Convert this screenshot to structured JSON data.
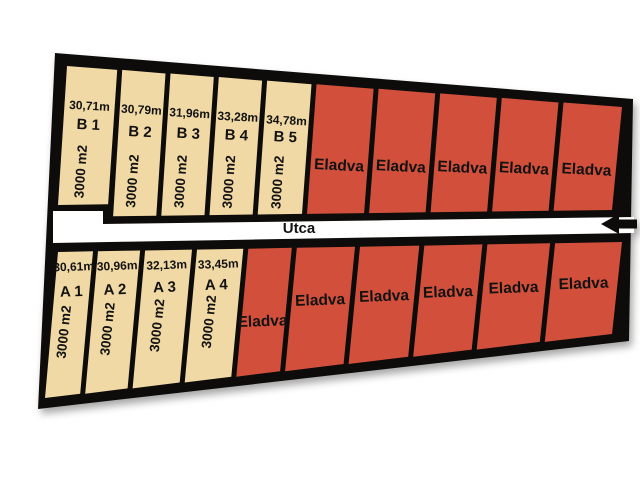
{
  "diagram": {
    "street": {
      "label": "Utca"
    },
    "sold_label": "Eladva",
    "colors": {
      "available": "#F0D9A4",
      "sold": "#D2503B",
      "outline": "#0D0C0A",
      "street": "#FFFFFF",
      "text": "#121212"
    },
    "rows": [
      {
        "name": "B",
        "plots": [
          {
            "status": "available",
            "label": "B 1",
            "frontage": "30,71m",
            "area": "3000 m2"
          },
          {
            "status": "available",
            "label": "B 2",
            "frontage": "30,79m",
            "area": "3000 m2"
          },
          {
            "status": "available",
            "label": "B 3",
            "frontage": "31,96m",
            "area": "3000 m2"
          },
          {
            "status": "available",
            "label": "B 4",
            "frontage": "33,28m",
            "area": "3000 m2"
          },
          {
            "status": "available",
            "label": "B 5",
            "frontage": "34,78m",
            "area": "3000 m2"
          },
          {
            "status": "sold"
          },
          {
            "status": "sold"
          },
          {
            "status": "sold"
          },
          {
            "status": "sold"
          },
          {
            "status": "sold"
          }
        ]
      },
      {
        "name": "A",
        "plots": [
          {
            "status": "available",
            "label": "A 1",
            "frontage": "30,61m",
            "area": "3000 m2"
          },
          {
            "status": "available",
            "label": "A 2",
            "frontage": "30,96m",
            "area": "3000 m2"
          },
          {
            "status": "available",
            "label": "A 3",
            "frontage": "32,13m",
            "area": "3000 m2"
          },
          {
            "status": "available",
            "label": "A 4",
            "frontage": "33,45m",
            "area": "3000 m2"
          },
          {
            "status": "sold"
          },
          {
            "status": "sold"
          },
          {
            "status": "sold"
          },
          {
            "status": "sold"
          },
          {
            "status": "sold"
          },
          {
            "status": "sold"
          }
        ]
      }
    ]
  }
}
